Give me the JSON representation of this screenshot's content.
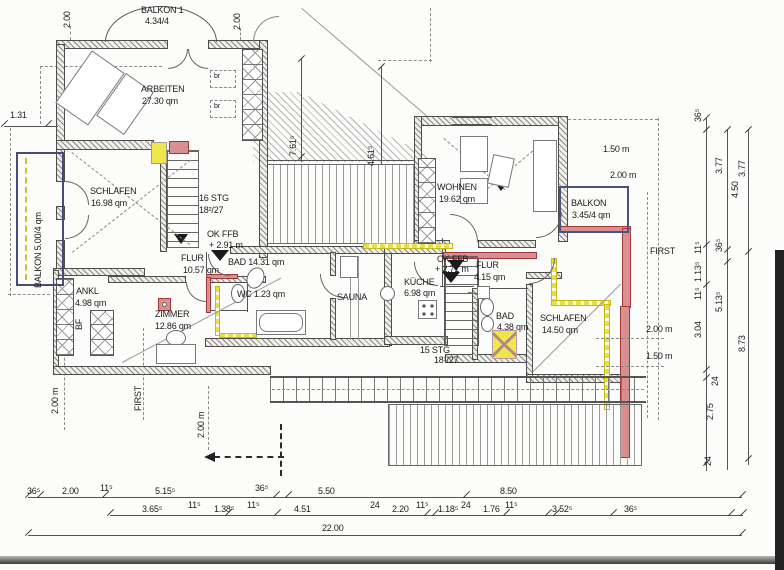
{
  "rooms": {
    "balkon1": {
      "l1": "BALKON 1",
      "l2": "4.34/4"
    },
    "arbeiten": {
      "l1": "ARBEITEN",
      "l2": "27.30 qm"
    },
    "schlafen1": {
      "l1": "SCHLAFEN",
      "l2": "16.98 qm"
    },
    "balkon_links": {
      "l1": "BALKON 5.00/4 qm"
    },
    "flur1": {
      "l1": "FLUR",
      "l2": "10.57 qm"
    },
    "bad1": {
      "l1": "BAD 14.31 qm"
    },
    "wc": {
      "l1": "WC 1.23 qm"
    },
    "sauna": {
      "l1": "SAUNA"
    },
    "kueche": {
      "l1": "KÜCHE",
      "l2": "6.98 qm"
    },
    "wohnen": {
      "l1": "WOHNEN",
      "l2": "19.62 qm"
    },
    "balkon_rechts": {
      "l1": "BALKON",
      "l2": "3.45/4 qm"
    },
    "flur2": {
      "l1": "FLUR",
      "l2": "4.15 qm"
    },
    "bad2": {
      "l1": "BAD",
      "l2": "4.38 qm"
    },
    "schlafen2": {
      "l1": "SCHLAFEN",
      "l2": "14.50 qm"
    },
    "zimmer": {
      "l1": "ZIMMER",
      "l2": "12.86 qm"
    },
    "ankl": {
      "l1": "ANKL",
      "l2": "4.98 qm"
    }
  },
  "stairs": {
    "s16": {
      "l1": "16 STG",
      "l2": "18²/27"
    },
    "s15": {
      "l1": "15 STG",
      "l2": "18¹/27"
    }
  },
  "levels": {
    "f1": {
      "l1": "OK FFB",
      "l2": "+ 2.91 m"
    },
    "f2": {
      "l1": "OK FFB",
      "l2": "+ 2.71 m"
    }
  },
  "annotations": {
    "first_right": "FIRST",
    "first_bottom": "FIRST",
    "m150_r1": "1.50 m",
    "m200_r1": "2.00 m",
    "m200_r2": "2.00 m",
    "m150_r2": "1.50 m",
    "m200_bl1": "2.00 m",
    "m200_bl2": "2.00 m",
    "bf": "BF",
    "br1": "br",
    "br2": "br"
  },
  "topdims": {
    "d200l": "2.00",
    "d131": "1.31",
    "d200r": "2.00",
    "d761": "7.61⁵",
    "d461": "4.61⁵"
  },
  "dims": {
    "b1": [
      "36⁵",
      "2.00",
      "11⁵",
      "5.15⁵",
      "36⁵",
      "5.50",
      "8.50"
    ],
    "b2": [
      "3.65⁵",
      "11⁵",
      "1.38⁵",
      "11⁵",
      "4.51",
      "24",
      "2.20",
      "11⁵",
      "1.18⁵",
      "24",
      "1.76",
      "11⁵",
      "3.52⁵",
      "36⁵"
    ],
    "total": "22.00",
    "ra": [
      "36⁵",
      "11⁵",
      "1.13⁵",
      "11⁵",
      "3.04",
      "24",
      "2.75",
      "24"
    ],
    "rb": [
      "3.77",
      "4.50",
      "36⁵",
      "5.13⁵"
    ],
    "rc": [
      "3.77",
      "8.73"
    ]
  },
  "colors": {
    "highlight_red": "#d98f8f",
    "highlight_yellow": "#e8df3e",
    "balcony_blue": "#474b78"
  }
}
